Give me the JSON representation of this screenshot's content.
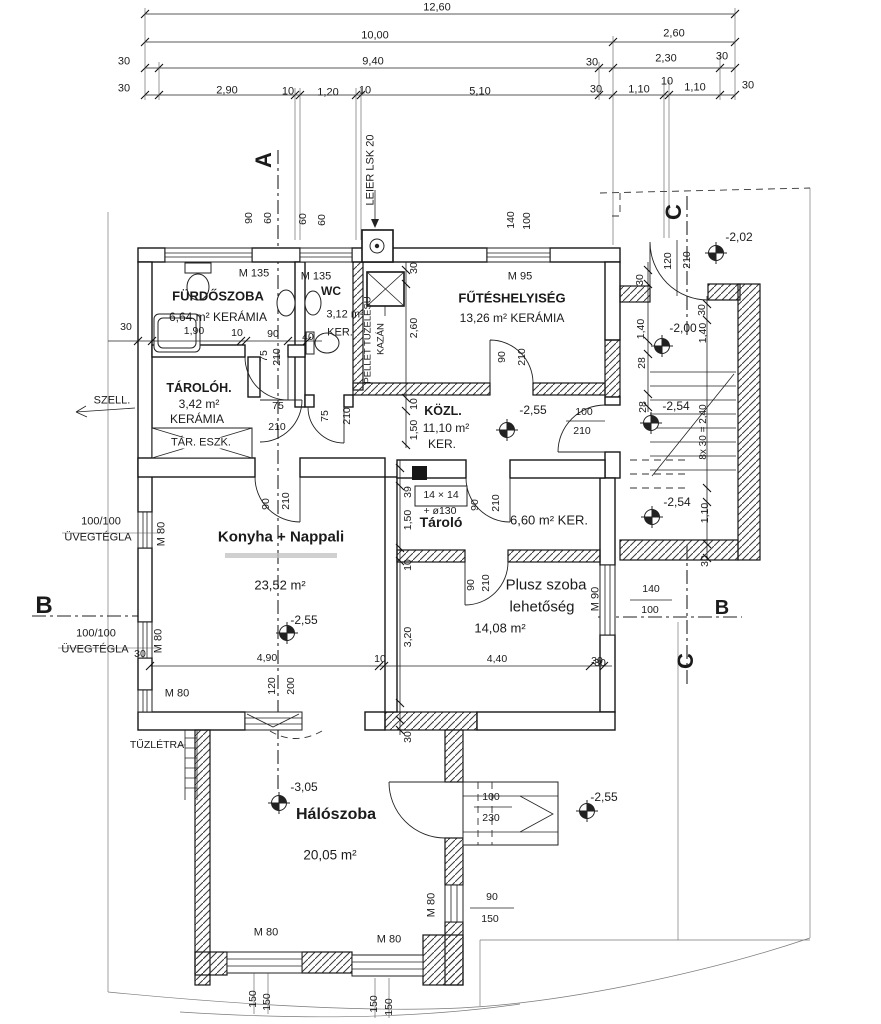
{
  "document": {
    "type": "architectural floor plan",
    "language": "Hungarian",
    "accent_color": "#1b1b1b",
    "paper_color": "#ffffff"
  },
  "rooms_summary": [
    {
      "name": "FÜRDŐSZOBA",
      "area": "6,64 m²",
      "finish": "KERÁMIA"
    },
    {
      "name": "WC",
      "area": "3,12 m²",
      "finish": "KER."
    },
    {
      "name": "FŰTÉSHELYISÉG",
      "area": "13,26 m²",
      "finish": "KERÁMIA"
    },
    {
      "name": "TÁROLÓH.",
      "area": "3,42 m²",
      "finish": "KERÁMIA"
    },
    {
      "name": "KÖZL.",
      "area": "11,10 m²",
      "finish": "KER."
    },
    {
      "name": "Konyha + Nappali",
      "area": "23,52 m²"
    },
    {
      "name": "Tároló",
      "area": "6,60 m²",
      "finish": "KER."
    },
    {
      "name": "Plusz szoba lehetőség",
      "area": "14,08 m²"
    },
    {
      "name": "Hálószoba",
      "area": "20,05 m²"
    }
  ],
  "annotations": {
    "dimension_chain_top": [
      {
        "t": "12,60",
        "x": 437,
        "y": 8
      },
      {
        "t": "10,00",
        "x": 375,
        "y": 36
      },
      {
        "t": "2,60",
        "x": 674,
        "y": 34
      },
      {
        "t": "30",
        "x": 124,
        "y": 62
      },
      {
        "t": "9,40",
        "x": 373,
        "y": 62
      },
      {
        "t": "30",
        "x": 592,
        "y": 63
      },
      {
        "t": "2,30",
        "x": 666,
        "y": 59
      },
      {
        "t": "30",
        "x": 722,
        "y": 57
      },
      {
        "t": "30",
        "x": 124,
        "y": 89
      },
      {
        "t": "2,90",
        "x": 227,
        "y": 91
      },
      {
        "t": "10",
        "x": 288,
        "y": 92
      },
      {
        "t": "1,20",
        "x": 328,
        "y": 93
      },
      {
        "t": "10",
        "x": 365,
        "y": 91
      },
      {
        "t": "5,10",
        "x": 480,
        "y": 92
      },
      {
        "t": "30",
        "x": 596,
        "y": 90
      },
      {
        "t": "1,10",
        "x": 639,
        "y": 90
      },
      {
        "t": "10",
        "x": 667,
        "y": 82
      },
      {
        "t": "1,10",
        "x": 695,
        "y": 88
      },
      {
        "t": "30",
        "x": 748,
        "y": 86
      }
    ],
    "section_markers": [
      {
        "t": "A",
        "x": 264,
        "y": 160,
        "r": -90,
        "b": 1,
        "fs": 22,
        "n": "section-marker-a"
      },
      {
        "t": "B",
        "x": 44,
        "y": 606,
        "b": 1,
        "fs": 24,
        "n": "section-marker-b-left"
      },
      {
        "t": "B",
        "x": 722,
        "y": 608,
        "b": 1,
        "fs": 20,
        "n": "section-marker-b-right"
      },
      {
        "t": "C",
        "x": 674,
        "y": 212,
        "r": -90,
        "b": 1,
        "fs": 22,
        "n": "section-marker-c-top"
      },
      {
        "t": "C",
        "x": 686,
        "y": 661,
        "r": -90,
        "b": 1,
        "fs": 22,
        "n": "section-marker-c-bottom"
      }
    ],
    "room_labels": [
      {
        "t": "FÜRDŐSZOBA",
        "x": 218,
        "y": 296,
        "b": 1,
        "fs": 13,
        "n": "room-furdoszoba"
      },
      {
        "t": "6,64 m² KERÁMIA",
        "x": 218,
        "y": 317,
        "fs": 12
      },
      {
        "t": "WC",
        "x": 331,
        "y": 291,
        "b": 1,
        "fs": 12,
        "n": "room-wc"
      },
      {
        "t": "3,12 m²",
        "x": 345,
        "y": 315,
        "fs": 11
      },
      {
        "t": "KER.",
        "x": 340,
        "y": 333,
        "fs": 11
      },
      {
        "t": "FŰTÉSHELYISÉG",
        "x": 512,
        "y": 298,
        "b": 1,
        "fs": 13,
        "n": "room-futeshelyiseg"
      },
      {
        "t": "13,26 m² KERÁMIA",
        "x": 512,
        "y": 318,
        "fs": 12
      },
      {
        "t": "TÁROLÓH.",
        "x": 199,
        "y": 388,
        "b": 1,
        "fs": 12.5,
        "n": "room-taroloh"
      },
      {
        "t": "3,42 m²",
        "x": 199,
        "y": 404,
        "fs": 12
      },
      {
        "t": "KERÁMIA",
        "x": 197,
        "y": 419,
        "fs": 12
      },
      {
        "t": "KÖZL.",
        "x": 443,
        "y": 411,
        "b": 1,
        "fs": 12.5,
        "n": "room-kozl"
      },
      {
        "t": "11,10 m²",
        "x": 446,
        "y": 428,
        "fs": 12
      },
      {
        "t": "KER.",
        "x": 442,
        "y": 444,
        "fs": 12
      },
      {
        "t": "Konyha + Nappali",
        "x": 281,
        "y": 537,
        "b": 1,
        "fs": 15,
        "n": "room-konyha-nappali"
      },
      {
        "t": "23,52 m²",
        "x": 280,
        "y": 585,
        "fs": 13
      },
      {
        "t": "Tároló",
        "x": 441,
        "y": 522,
        "b": 1,
        "fs": 14,
        "n": "room-tarolo"
      },
      {
        "t": "6,60 m² KER.",
        "x": 549,
        "y": 520,
        "fs": 13
      },
      {
        "t": "Plusz szoba",
        "x": 546,
        "y": 585,
        "fs": 15,
        "n": "room-plusz-szoba"
      },
      {
        "t": "lehetőség",
        "x": 542,
        "y": 607,
        "fs": 15
      },
      {
        "t": "14,08 m²",
        "x": 500,
        "y": 628,
        "fs": 13
      },
      {
        "t": "Hálószoba",
        "x": 336,
        "y": 815,
        "b": 1,
        "fs": 16,
        "n": "room-haloszoba"
      },
      {
        "t": "20,05 m²",
        "x": 330,
        "y": 855,
        "fs": 13.5
      }
    ],
    "window_labels": [
      {
        "t": "M 135",
        "x": 254,
        "y": 274
      },
      {
        "t": "M 135",
        "x": 316,
        "y": 277
      },
      {
        "t": "M 95",
        "x": 520,
        "y": 277
      },
      {
        "t": "M 80",
        "x": 162,
        "y": 534,
        "r": -90
      },
      {
        "t": "M 80",
        "x": 159,
        "y": 641,
        "r": -90
      },
      {
        "t": "M 80",
        "x": 177,
        "y": 694
      },
      {
        "t": "M 90",
        "x": 596,
        "y": 599,
        "r": -90
      },
      {
        "t": "M 80",
        "x": 432,
        "y": 905,
        "r": -90
      },
      {
        "t": "M 80",
        "x": 266,
        "y": 933
      },
      {
        "t": "M 80",
        "x": 389,
        "y": 940
      }
    ],
    "wall_dimensions": [
      {
        "t": "90",
        "x": 249,
        "y": 218,
        "r": -90,
        "fs": 10.5
      },
      {
        "t": "60",
        "x": 268,
        "y": 218,
        "r": -90,
        "fs": 10.5
      },
      {
        "t": "60",
        "x": 303,
        "y": 219,
        "r": -90,
        "fs": 10.5
      },
      {
        "t": "60",
        "x": 322,
        "y": 220,
        "r": -90,
        "fs": 10.5
      },
      {
        "t": "140",
        "x": 511,
        "y": 220,
        "r": -90,
        "fs": 10.5
      },
      {
        "t": "100",
        "x": 527,
        "y": 221,
        "r": -90,
        "fs": 10.5
      },
      {
        "t": "30",
        "x": 126,
        "y": 327,
        "fs": 10.5
      },
      {
        "t": "1,90",
        "x": 194,
        "y": 331,
        "fs": 10.5
      },
      {
        "t": "10",
        "x": 237,
        "y": 333,
        "fs": 10.5
      },
      {
        "t": "90",
        "x": 273,
        "y": 334,
        "fs": 10.5
      },
      {
        "t": "40",
        "x": 308,
        "y": 337,
        "fs": 10.5
      },
      {
        "t": "30",
        "x": 414,
        "y": 268,
        "r": -90,
        "fs": 10.5
      },
      {
        "t": "2,60",
        "x": 414,
        "y": 328,
        "r": -90,
        "fs": 10.5
      },
      {
        "t": "10",
        "x": 414,
        "y": 404,
        "r": -90,
        "fs": 10.5
      },
      {
        "t": "1,50",
        "x": 414,
        "y": 430,
        "r": -90,
        "fs": 10.5
      },
      {
        "t": "39",
        "x": 408,
        "y": 492,
        "r": -90,
        "fs": 10.5
      },
      {
        "t": "1,50",
        "x": 408,
        "y": 520,
        "r": -90,
        "fs": 10.5
      },
      {
        "t": "10",
        "x": 408,
        "y": 565,
        "r": -90,
        "fs": 10.5
      },
      {
        "t": "3,20",
        "x": 408,
        "y": 637,
        "r": -90,
        "fs": 10.5
      },
      {
        "t": "30",
        "x": 408,
        "y": 737,
        "r": -90,
        "fs": 10.5
      },
      {
        "t": "30",
        "x": 640,
        "y": 280,
        "r": -90,
        "fs": 10.5
      },
      {
        "t": "1,40",
        "x": 641,
        "y": 329,
        "r": -90,
        "fs": 10.5
      },
      {
        "t": "28",
        "x": 642,
        "y": 363,
        "r": -90,
        "fs": 10.5
      },
      {
        "t": "28",
        "x": 643,
        "y": 407,
        "r": -90,
        "fs": 10.5
      },
      {
        "t": "30",
        "x": 702,
        "y": 310,
        "r": -90,
        "fs": 10.5
      },
      {
        "t": "1,40",
        "x": 703,
        "y": 333,
        "r": -90,
        "fs": 10.5
      },
      {
        "t": "8x 30 = 2,40",
        "x": 704,
        "y": 432,
        "r": -90,
        "fs": 10
      },
      {
        "t": "1,10",
        "x": 705,
        "y": 513,
        "r": -90,
        "fs": 10.5
      },
      {
        "t": "30",
        "x": 705,
        "y": 561,
        "r": -90,
        "fs": 10.5
      },
      {
        "t": "140",
        "x": 651,
        "y": 589,
        "fs": 10.5
      },
      {
        "t": "100",
        "x": 650,
        "y": 610,
        "fs": 10.5
      },
      {
        "t": "30",
        "x": 600,
        "y": 663,
        "fs": 10.5
      },
      {
        "t": "4,90",
        "x": 267,
        "y": 658,
        "fs": 10.5
      },
      {
        "t": "10",
        "x": 380,
        "y": 659,
        "fs": 10.5
      },
      {
        "t": "4,40",
        "x": 497,
        "y": 659,
        "fs": 10.5
      },
      {
        "t": "30",
        "x": 597,
        "y": 661,
        "fs": 10.5
      },
      {
        "t": "120",
        "x": 272,
        "y": 686,
        "r": -90,
        "fs": 10.5
      },
      {
        "t": "200",
        "x": 291,
        "y": 686,
        "r": -90,
        "fs": 10.5
      },
      {
        "t": "30",
        "x": 140,
        "y": 654,
        "fs": 10.5
      },
      {
        "t": "90",
        "x": 492,
        "y": 897,
        "fs": 10.5
      },
      {
        "t": "150",
        "x": 490,
        "y": 919,
        "fs": 10.5
      },
      {
        "t": "150",
        "x": 253,
        "y": 999,
        "r": -90,
        "fs": 10.5
      },
      {
        "t": "150",
        "x": 267,
        "y": 1002,
        "r": -90,
        "fs": 10.5
      },
      {
        "t": "150",
        "x": 374,
        "y": 1004,
        "r": -90,
        "fs": 10.5
      },
      {
        "t": "150",
        "x": 389,
        "y": 1007,
        "r": -90,
        "fs": 10.5
      }
    ],
    "door_dimensions": [
      {
        "t": "75",
        "x": 264,
        "y": 356,
        "r": -90,
        "fs": 10.5
      },
      {
        "t": "210",
        "x": 277,
        "y": 357,
        "r": -90,
        "fs": 10.5
      },
      {
        "t": "75",
        "x": 325,
        "y": 416,
        "r": -90,
        "fs": 10.5
      },
      {
        "t": "210",
        "x": 347,
        "y": 416,
        "r": -90,
        "fs": 10.5
      },
      {
        "t": "75",
        "x": 278,
        "y": 406,
        "fs": 10.5
      },
      {
        "t": "210",
        "x": 277,
        "y": 427,
        "fs": 10.5
      },
      {
        "t": "90",
        "x": 502,
        "y": 357,
        "r": -90,
        "fs": 10.5
      },
      {
        "t": "210",
        "x": 522,
        "y": 357,
        "r": -90,
        "fs": 10.5
      },
      {
        "t": "90",
        "x": 266,
        "y": 504,
        "r": -90,
        "fs": 10.5
      },
      {
        "t": "210",
        "x": 286,
        "y": 501,
        "r": -90,
        "fs": 10.5
      },
      {
        "t": "90",
        "x": 475,
        "y": 505,
        "r": -90,
        "fs": 10.5
      },
      {
        "t": "210",
        "x": 496,
        "y": 503,
        "r": -90,
        "fs": 10.5
      },
      {
        "t": "90",
        "x": 471,
        "y": 585,
        "r": -90,
        "fs": 10.5
      },
      {
        "t": "210",
        "x": 486,
        "y": 583,
        "r": -90,
        "fs": 10.5
      },
      {
        "t": "100",
        "x": 584,
        "y": 412,
        "fs": 10.5
      },
      {
        "t": "210",
        "x": 582,
        "y": 431,
        "fs": 10.5
      },
      {
        "t": "120",
        "x": 668,
        "y": 261,
        "r": -90,
        "fs": 10.5
      },
      {
        "t": "210",
        "x": 687,
        "y": 260,
        "r": -90,
        "fs": 10.5
      },
      {
        "t": "100",
        "x": 491,
        "y": 797,
        "fs": 10.5
      },
      {
        "t": "230",
        "x": 491,
        "y": 818,
        "fs": 10.5
      }
    ],
    "level_markers": [
      {
        "t": "-2,02",
        "x": 739,
        "y": 237,
        "fs": 12,
        "n": "level-minus-2-02"
      },
      {
        "t": "-2,00",
        "x": 683,
        "y": 328,
        "fs": 12,
        "n": "level-minus-2-00"
      },
      {
        "t": "-2,54",
        "x": 676,
        "y": 406,
        "fs": 12,
        "n": "level-minus-2-54"
      },
      {
        "t": "-2,54",
        "x": 677,
        "y": 502,
        "fs": 12,
        "n": "level-minus-2-54"
      },
      {
        "t": "-2,55",
        "x": 533,
        "y": 410,
        "fs": 12,
        "n": "level-minus-2-55"
      },
      {
        "t": "-2,55",
        "x": 304,
        "y": 620,
        "fs": 12,
        "n": "level-minus-2-55"
      },
      {
        "t": "-3,05",
        "x": 304,
        "y": 787,
        "fs": 12,
        "n": "level-minus-3-05"
      },
      {
        "t": "-2,55",
        "x": 604,
        "y": 797,
        "fs": 12,
        "n": "level-minus-2-55"
      }
    ],
    "misc": [
      {
        "t": "LEIER LSK 20",
        "x": 371,
        "y": 170,
        "r": -90,
        "fs": 11,
        "n": "chimney-label"
      },
      {
        "t": "PELLET TÜZELÉSŰ",
        "x": 368,
        "y": 340,
        "r": -90,
        "fs": 9.5,
        "n": "boiler-label"
      },
      {
        "t": "KAZÁN",
        "x": 381,
        "y": 339,
        "r": -90,
        "fs": 9.5,
        "n": "boiler-label"
      },
      {
        "t": "TÁR. ESZK.",
        "x": 201,
        "y": 443,
        "fs": 11,
        "bg": 1,
        "n": "storage-equipment-label"
      },
      {
        "t": "SZELL.",
        "x": 112,
        "y": 401,
        "fs": 11,
        "n": "ventilation-label"
      },
      {
        "t": "100/100",
        "x": 101,
        "y": 522,
        "fs": 11,
        "n": "glass-block-label"
      },
      {
        "t": "ÜVEGTÉGLA",
        "x": 98,
        "y": 538,
        "fs": 11
      },
      {
        "t": "100/100",
        "x": 96,
        "y": 634,
        "fs": 11,
        "n": "glass-block-label"
      },
      {
        "t": "ÜVEGTÉGLA",
        "x": 95,
        "y": 650,
        "fs": 11
      },
      {
        "t": "TŰZLÉTRA",
        "x": 157,
        "y": 745,
        "fs": 10.5,
        "n": "fire-ladder-label"
      },
      {
        "t": "14 × 14",
        "x": 441,
        "y": 495,
        "fs": 10.5,
        "n": "flue-size-label"
      },
      {
        "t": "+ ø130",
        "x": 440,
        "y": 511,
        "fs": 10.5,
        "n": "flue-diameter-label"
      }
    ]
  }
}
